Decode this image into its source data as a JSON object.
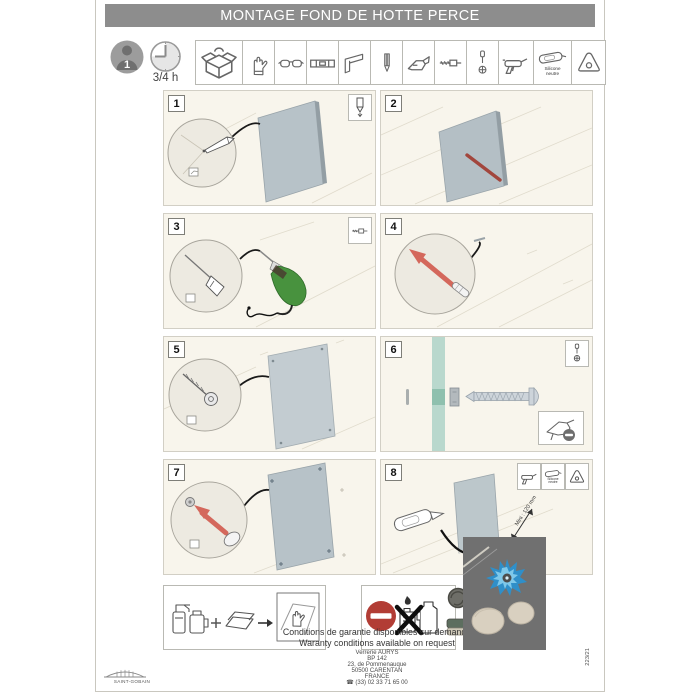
{
  "page": {
    "title": "MONTAGE FOND DE HOTTE PERCE",
    "doc_ref": "223/21",
    "header_bg": "#8d8d8d",
    "panel_bg": "#f8f5ec",
    "glass_color": "#b7c2c8",
    "accent_red": "#c0564a",
    "flame_blue": "#2f8fc9"
  },
  "prep": {
    "persons": "1",
    "duration": "3/4 h",
    "tools": [
      "toolbox",
      "work-gloves",
      "safety-glasses",
      "spirit-level",
      "square",
      "pencil",
      "cutter-knife",
      "drill-bit",
      "screwdriver",
      "caulk-gun",
      "silicone-cartridge",
      "scraper"
    ],
    "silicone_line1": "Silicone",
    "silicone_line2": "neutre"
  },
  "steps": [
    {
      "number": "1",
      "corner_icons": [
        "pencil-icon"
      ]
    },
    {
      "number": "2",
      "corner_icons": []
    },
    {
      "number": "3",
      "corner_icons": [
        "drill-bit-icon"
      ]
    },
    {
      "number": "4",
      "corner_icons": []
    },
    {
      "number": "5",
      "corner_icons": []
    },
    {
      "number": "6",
      "corner_icons": [
        "screwdriver-icon"
      ],
      "note_icon": "no-electric-screwdriver-icon"
    },
    {
      "number": "7",
      "corner_icons": []
    },
    {
      "number": "8",
      "corner_icons": [
        "caulk-gun-icon",
        "silicone-cartridge-icon",
        "scraper-icon"
      ],
      "min_distance_label": "Mini : 120 mm"
    }
  ],
  "care": {
    "allowed_icons": [
      "spray-bottle",
      "jug",
      "plus",
      "soft-cloth",
      "arrow-right",
      "hand-wipe"
    ],
    "forbidden_icons": [
      "no-entry-sign",
      "flammable-product",
      "solvent-bottle",
      "steel-wool",
      "abrasive-sponge"
    ]
  },
  "footer": {
    "warranty_fr": "Conditions de garantie disponibles sur demande",
    "warranty_en": "Waranty conditions available on request",
    "address_lines": [
      "Verrerie AURYS",
      "BP 142",
      "23, de Pommenauque",
      "50500 CARENTAN",
      "FRANCE",
      "☎ (33) 02 33 71 65 00"
    ],
    "brand": "SAINT-GOBAIN"
  }
}
